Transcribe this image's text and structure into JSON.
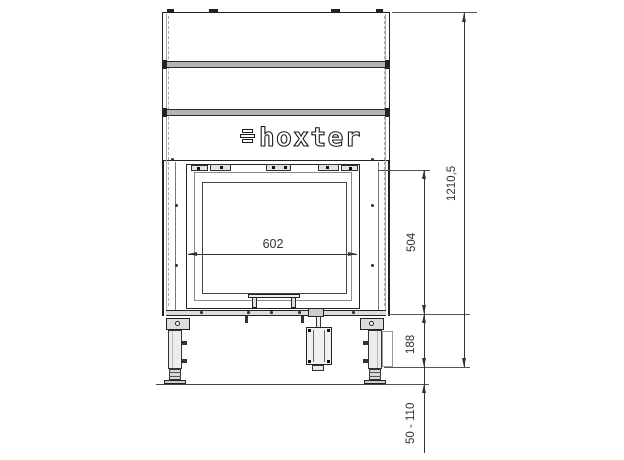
{
  "drawing": {
    "brand_logo": "hoxter",
    "dimensions": {
      "glass_width": "602",
      "door_height": "504",
      "total_height": "1210,5",
      "base_height": "188",
      "feet_adjust_range": "50 - 110"
    }
  }
}
